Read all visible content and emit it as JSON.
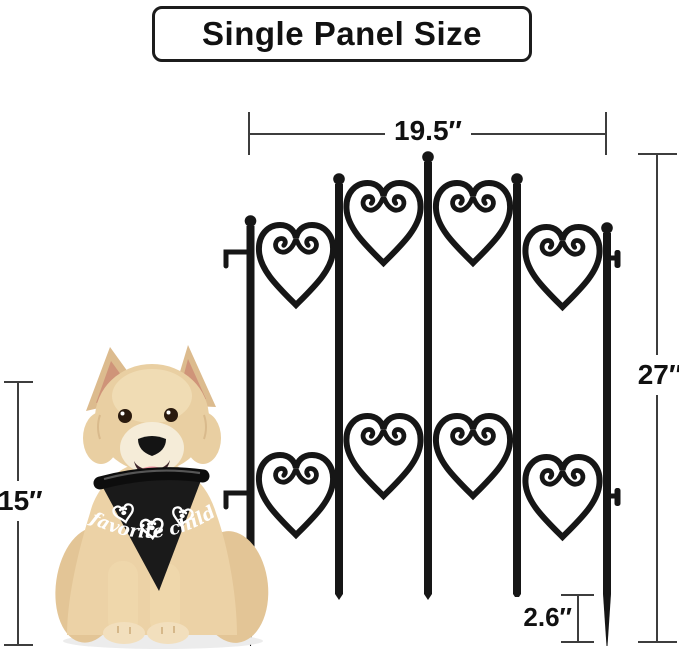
{
  "title": "Single Panel Size",
  "dimensions": {
    "panel_width": {
      "label": "19.5″",
      "value_inches": 19.5
    },
    "panel_height": {
      "label": "27″",
      "value_inches": 27
    },
    "dog_height": {
      "label": "15″",
      "value_inches": 15
    },
    "ground_stake": {
      "label": "2.6″",
      "value_inches": 2.6
    }
  },
  "fence": {
    "posts": 5,
    "heart_rows": 2,
    "hearts_per_row": 4,
    "color": "#161616"
  },
  "dog": {
    "bandana_text": "favorite child",
    "bandana_color": "#1a1a1a",
    "coat_color": "#e9cfa4"
  },
  "colors": {
    "background": "#ffffff",
    "dimension_lines": "#3d3d3d",
    "label_text": "#111111",
    "title_border": "#1c1c1c"
  }
}
